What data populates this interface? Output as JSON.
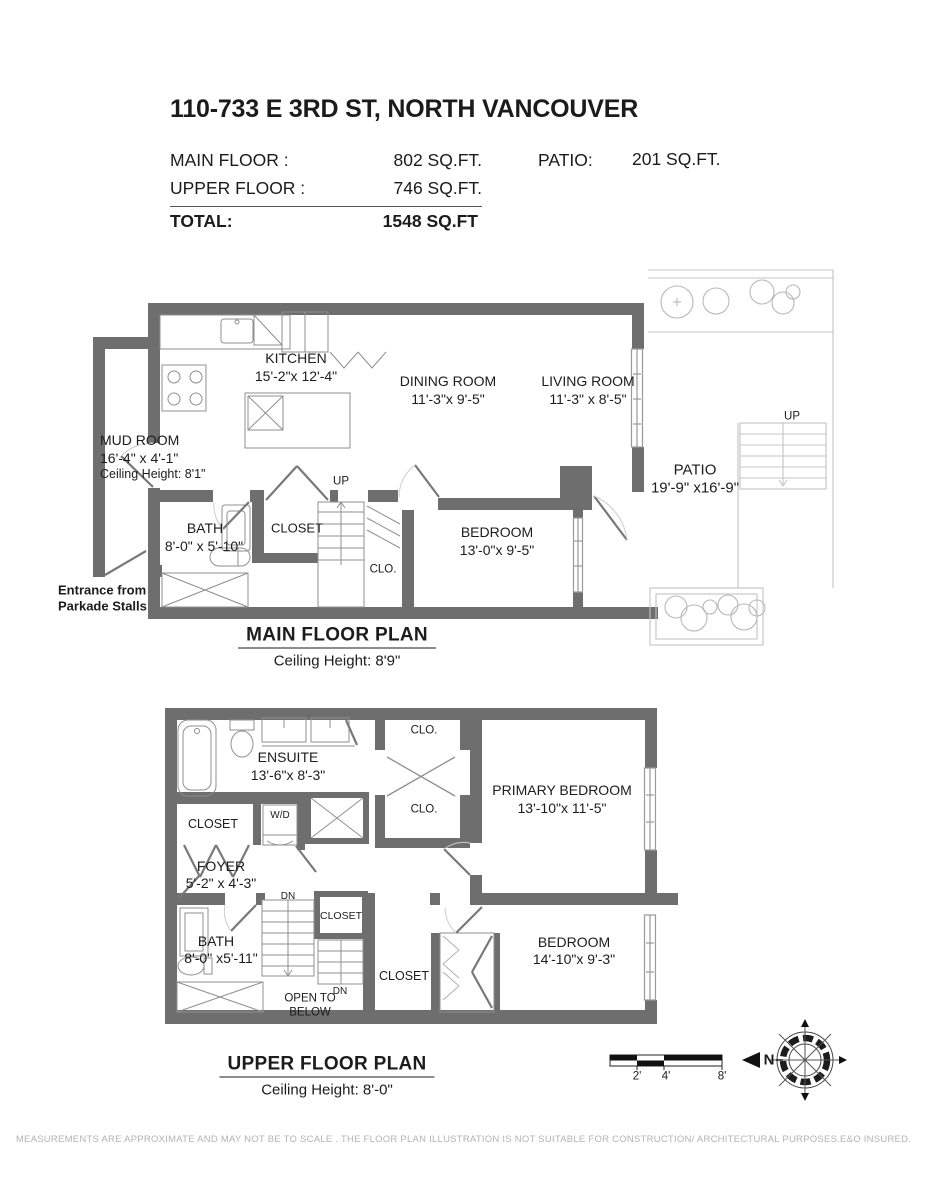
{
  "header": {
    "title": "110-733 E 3RD ST, NORTH VANCOUVER",
    "main_floor_label": "MAIN FLOOR :",
    "main_floor_value": "802 SQ.FT.",
    "upper_floor_label": "UPPER FLOOR :",
    "upper_floor_value": "746 SQ.FT.",
    "patio_label": "PATIO:",
    "patio_value": "201 SQ.FT.",
    "total_label": "TOTAL:",
    "total_value": "1548 SQ.FT"
  },
  "main_floor": {
    "title": "MAIN FLOOR PLAN",
    "ceiling": "Ceiling Height: 8'9\"",
    "labels": {
      "kitchen": {
        "name": "KITCHEN",
        "dims": "15'-2\"x 12'-4\""
      },
      "dining_room": {
        "name": "DINING ROOM",
        "dims": "11'-3\"x 9'-5\""
      },
      "living_room": {
        "name": "LIVING ROOM",
        "dims": "11'-3\" x 8'-5\""
      },
      "mud_room": {
        "name": "MUD ROOM",
        "dims": "16'-4\" x 4'-1\"",
        "ceiling": "Ceiling Height: 8'1\""
      },
      "bath": {
        "name": "BATH",
        "dims": "8'-0\" x 5'-10\""
      },
      "closet": "CLOSET",
      "clo": "CLO.",
      "bedroom": {
        "name": "BEDROOM",
        "dims": "13'-0\"x  9'-5\""
      },
      "patio": {
        "name": "PATIO",
        "dims": "19'-9\" x16'-9\""
      },
      "up_stairs": "UP",
      "up_patio": "UP",
      "entrance_line1": "Entrance from",
      "entrance_line2": "Parkade Stalls"
    }
  },
  "upper_floor": {
    "title": "UPPER FLOOR PLAN",
    "ceiling": "Ceiling Height: 8'-0\"",
    "labels": {
      "ensuite": {
        "name": "ENSUITE",
        "dims": "13'-6\"x  8'-3\""
      },
      "clo_top": "CLO.",
      "clo_bottom": "CLO.",
      "primary_bedroom": {
        "name": "PRIMARY BEDROOM",
        "dims": "13'-10\"x 11'-5\""
      },
      "closet_left": "CLOSET",
      "washer_dryer": "W/D",
      "foyer": {
        "name": "FOYER",
        "dims": "5'-2\" x  4'-3\""
      },
      "bath": {
        "name": "BATH",
        "dims": "8'-0\" x5'-11\""
      },
      "dn_top": "DN",
      "closet_stairs": "CLOSET",
      "dn_bottom": "DN",
      "open_below_line1": "OPEN TO",
      "open_below_line2": "BELOW",
      "closet_mid": "CLOSET",
      "bedroom": {
        "name": "BEDROOM",
        "dims": "14'-10\"x 9'-3\""
      }
    }
  },
  "scale_bar": {
    "tick_2": "2'",
    "tick_4": "4'",
    "tick_8": "8'"
  },
  "compass": {
    "north": "N"
  },
  "footer": {
    "disclaimer": "MEASUREMENTS ARE APPROXIMATE AND MAY NOT BE TO SCALE . THE FLOOR PLAN ILLUSTRATION IS NOT SUITABLE FOR CONSTRUCTION/ ARCHITECTURAL PURPOSES.E&O INSURED."
  }
}
